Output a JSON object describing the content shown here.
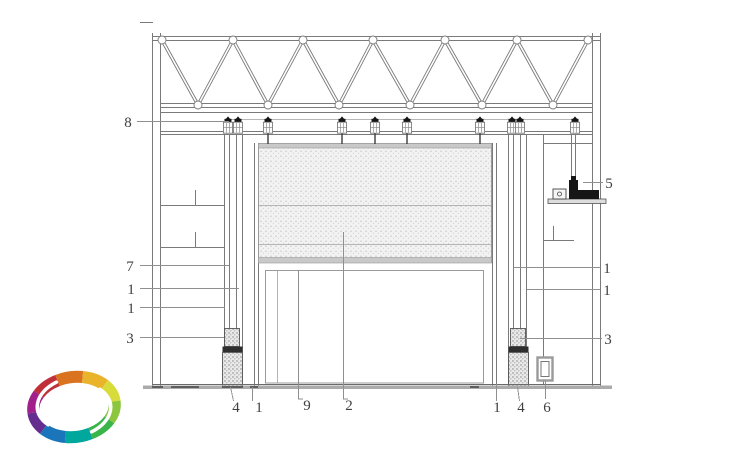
{
  "drawing": {
    "background": "#ffffff",
    "line_color": "#7a7a7a",
    "dark_color": "#1f1f1f",
    "leader_color": "#8f8f8f",
    "label_color": "#3f3f3f",
    "floor_color": "#ababab",
    "panel_strip": "#c9c9c9"
  },
  "callouts": [
    {
      "id": "hanger-track",
      "text": "8",
      "side": "left"
    },
    {
      "id": "rail-upper",
      "text": "7",
      "side": "left"
    },
    {
      "id": "guide-left-a",
      "text": "1",
      "side": "left"
    },
    {
      "id": "guide-left-b",
      "text": "1",
      "side": "left"
    },
    {
      "id": "buffer-left",
      "text": "3",
      "side": "left"
    },
    {
      "id": "drive-motor",
      "text": "5",
      "side": "right"
    },
    {
      "id": "guide-right-a",
      "text": "1",
      "side": "right"
    },
    {
      "id": "guide-right-b",
      "text": "1",
      "side": "right"
    },
    {
      "id": "buffer-right",
      "text": "3",
      "side": "right"
    },
    {
      "id": "base-left",
      "text": "4",
      "side": "bottom"
    },
    {
      "id": "jamb-left",
      "text": "1",
      "side": "bottom"
    },
    {
      "id": "inner-frame",
      "text": "9",
      "side": "bottom"
    },
    {
      "id": "curtain-panel",
      "text": "2",
      "side": "bottom"
    },
    {
      "id": "jamb-right",
      "text": "1",
      "side": "bottom"
    },
    {
      "id": "base-right",
      "text": "4",
      "side": "bottom"
    },
    {
      "id": "floor-box",
      "text": "6",
      "side": "bottom"
    }
  ],
  "logo": {
    "name": "rainbow-ring-logo",
    "colors": [
      "#a2208c",
      "#bf3038",
      "#d9731f",
      "#e9b32c",
      "#d8dc3a",
      "#8cc63f",
      "#39b54a",
      "#00a79d",
      "#1b75bb",
      "#662d91"
    ]
  }
}
